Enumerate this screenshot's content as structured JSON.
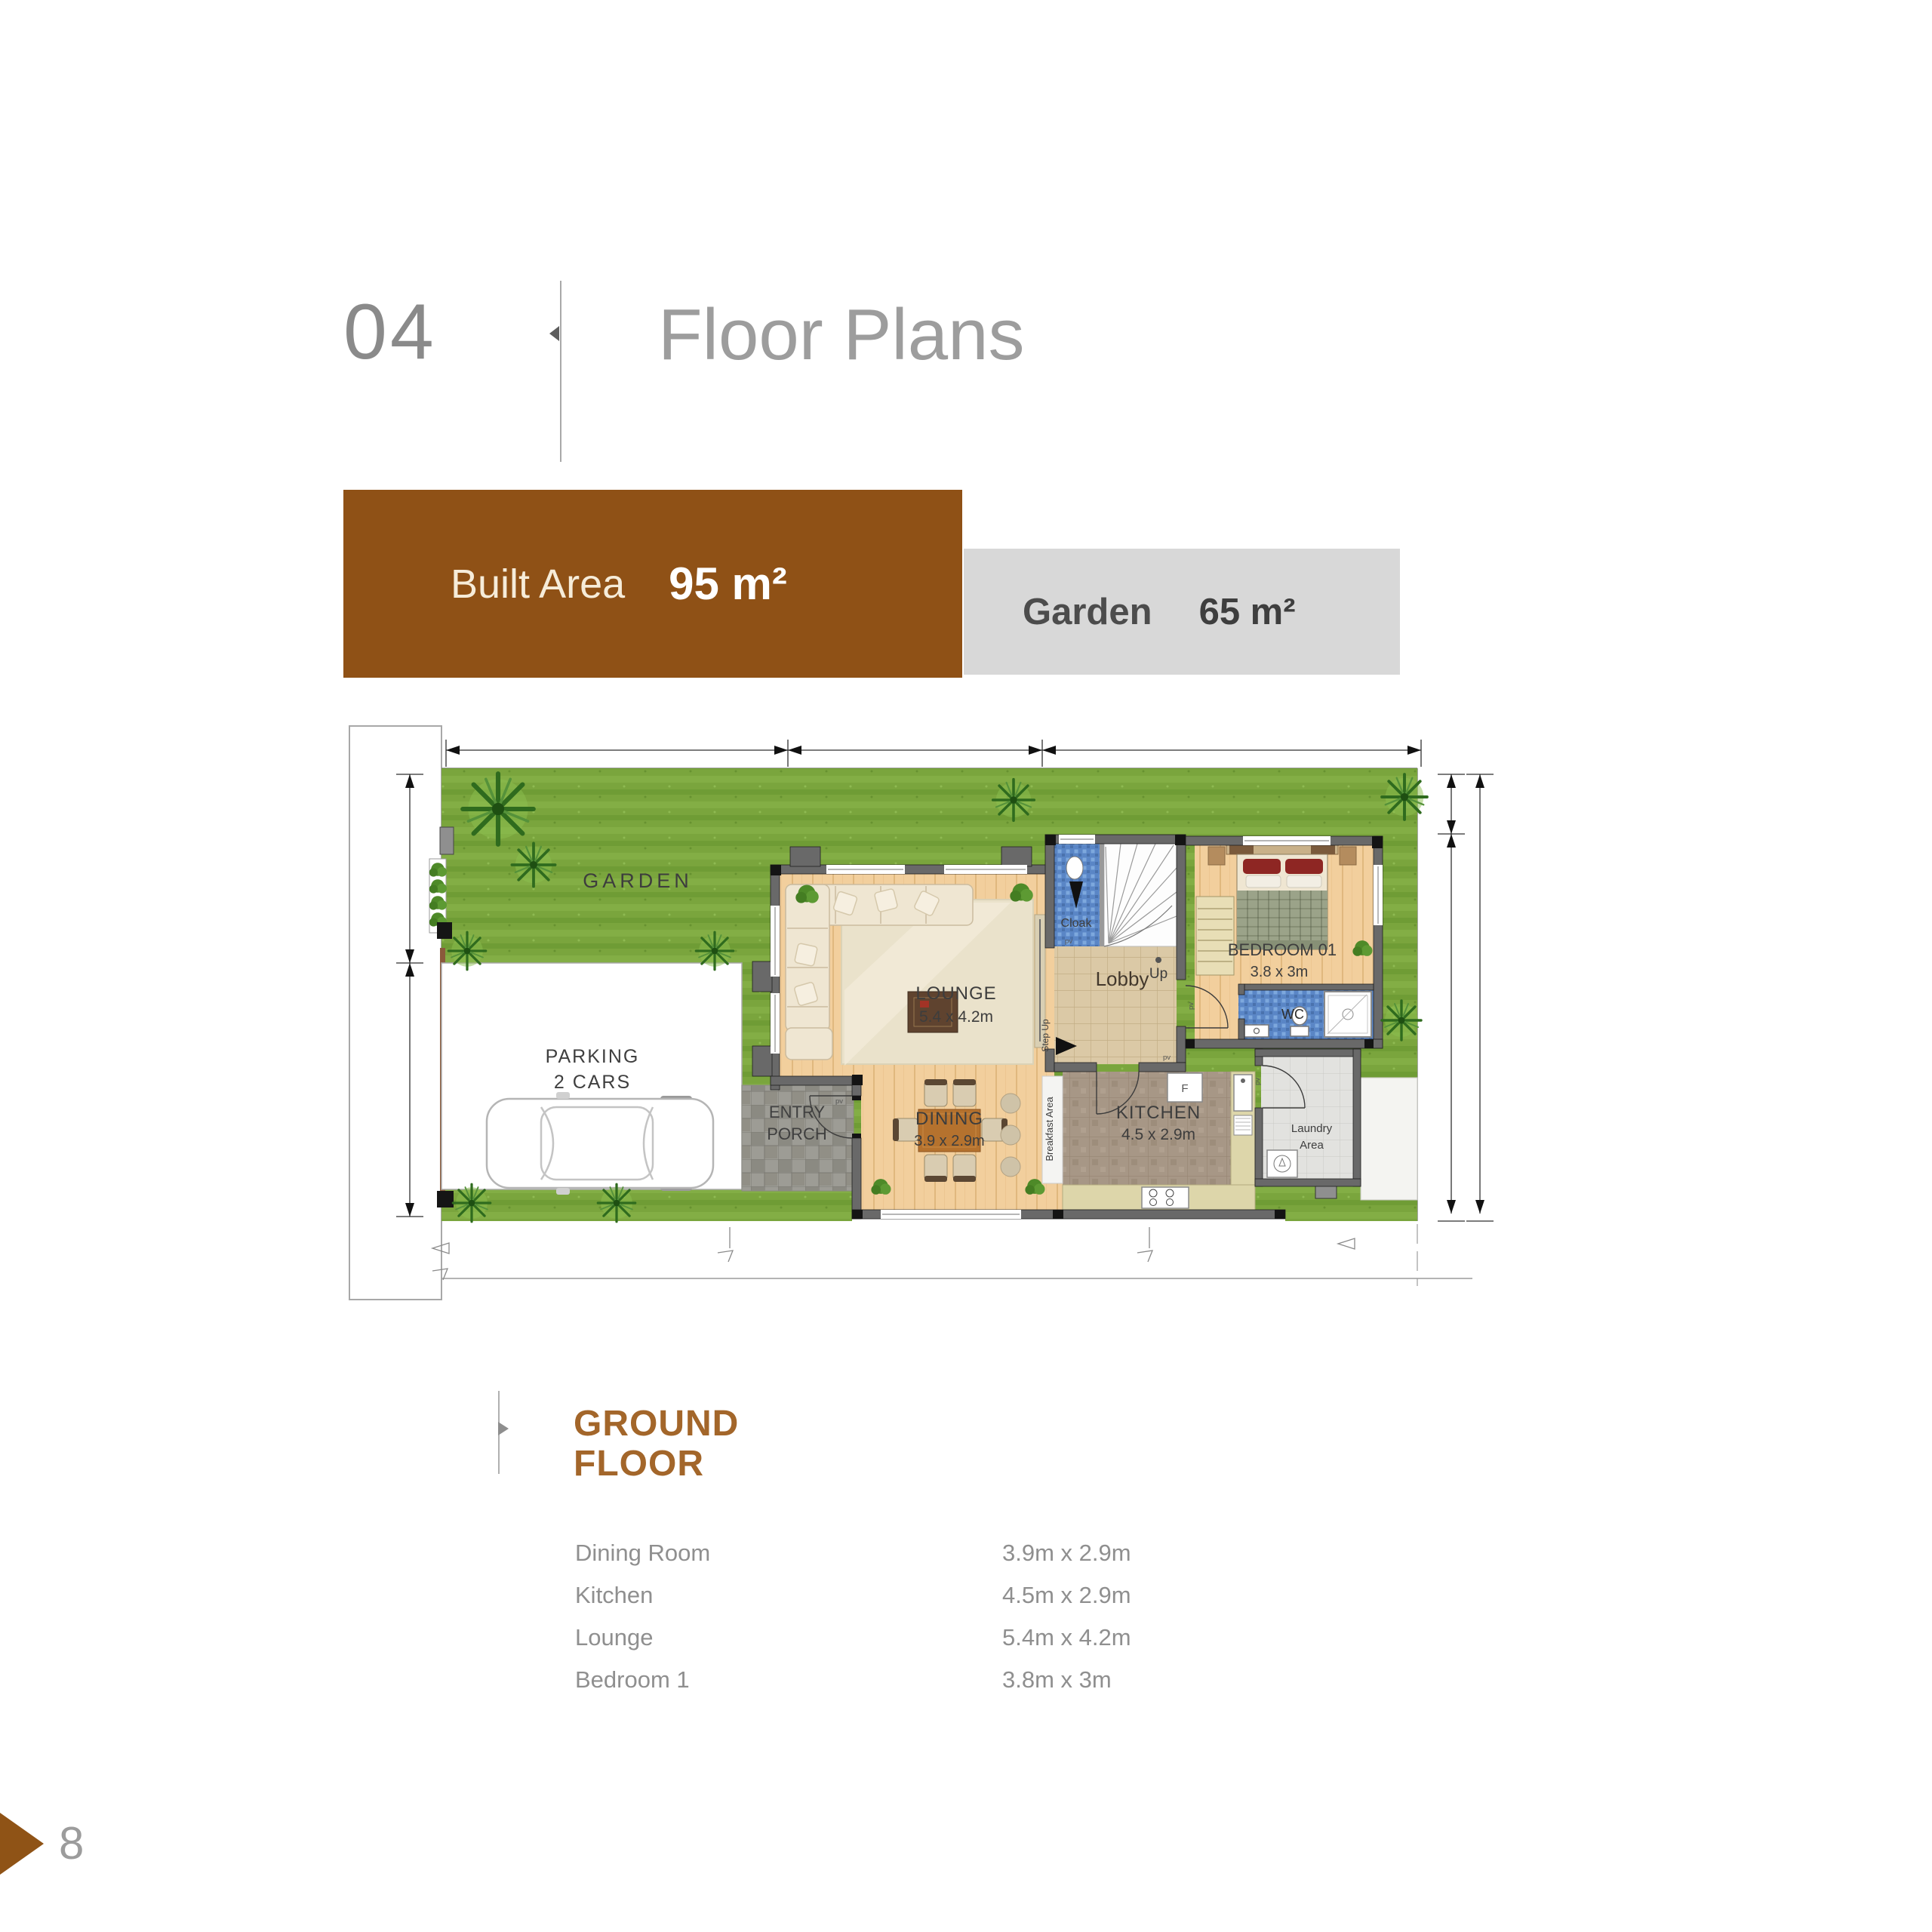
{
  "header": {
    "number": "04",
    "title": "Floor Plans"
  },
  "banners": {
    "built_area": {
      "label": "Built Area",
      "value": "95 m²",
      "bg": "#8F5116"
    },
    "garden": {
      "label": "Garden",
      "value": "65 m²",
      "bg": "#D8D8D8"
    }
  },
  "plan": {
    "labels": {
      "garden": "GARDEN",
      "parking1": "PARKING",
      "parking2": "2 CARS",
      "entry1": "ENTRY",
      "entry2": "PORCH",
      "lounge": "LOUNGE",
      "lounge_dim": "5.4 x 4.2m",
      "dining": "DINING",
      "dining_dim": "3.9 x 2.9m",
      "breakfast": "Breakfast Area",
      "kitchen": "KITCHEN",
      "kitchen_dim": "4.5 x 2.9m",
      "laundry1": "Laundry",
      "laundry2": "Area",
      "lobby": "Lobby",
      "up": "Up",
      "cloak": "Cloak",
      "step_up": "Step Up",
      "wc": "WC",
      "bedroom": "BEDROOM 01",
      "bedroom_dim": "3.8 x 3m",
      "fridge": "F",
      "pv": "pv"
    }
  },
  "floor_section": {
    "heading1": "GROUND",
    "heading2": "FLOOR",
    "rooms": [
      {
        "name": "Dining Room",
        "dimensions": "3.9m x 2.9m"
      },
      {
        "name": "Kitchen",
        "dimensions": "4.5m x 2.9m"
      },
      {
        "name": "Lounge",
        "dimensions": "5.4m x 4.2m"
      },
      {
        "name": "Bedroom 1",
        "dimensions": "3.8m x 3m"
      }
    ]
  },
  "footer": {
    "page_number": "8"
  },
  "colors": {
    "accent_brown": "#8F5116",
    "heading_brown": "#A3662A",
    "banner_gray": "#D8D8D8",
    "garden_green": "#7AA53D"
  }
}
